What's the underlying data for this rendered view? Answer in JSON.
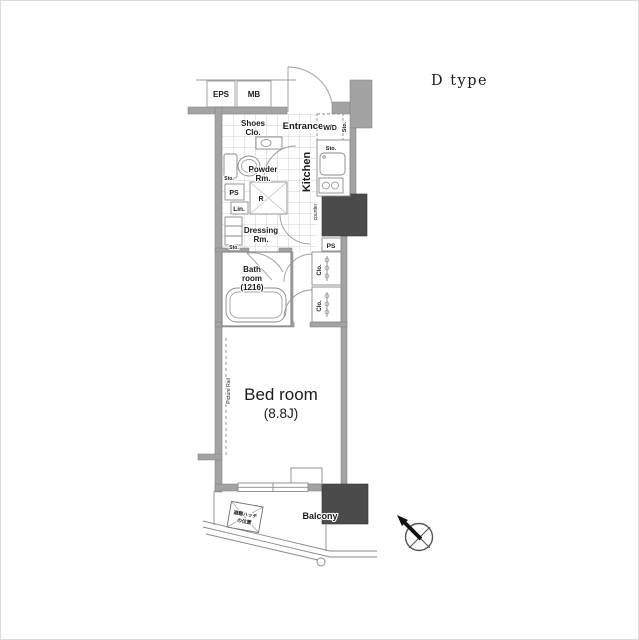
{
  "title": "D type",
  "labels": {
    "eps": "EPS",
    "mb": "MB",
    "entrance": "Entrance",
    "wd": "W/D",
    "sto": "Sto.",
    "shoes_line1": "Shoes",
    "shoes_line2": "Clo.",
    "kitchen": "Kitchen",
    "counter": "counter",
    "powder_line1": "Powder",
    "powder_line2": "Rm.",
    "ps": "PS",
    "lin": "Lin.",
    "refrigerator": "R",
    "dressing_line1": "Dressing",
    "dressing_line2": "Rm.",
    "bath_line1": "Bath",
    "bath_line2": "room",
    "bath_line3": "(1216)",
    "closet": "Clo.",
    "bedroom_name": "Bed room",
    "bedroom_size": "(8.8J)",
    "picture_rail": "Picture Rail",
    "balcony": "Balcony",
    "hatch_line1": "避難ハッチ",
    "hatch_line2": "の位置"
  },
  "colors": {
    "wall": "#a3a3a3",
    "pillar": "#4b4b4b",
    "outline": "#8a8a8a",
    "grid": "#c3c3c3",
    "text": "#1b1b1b"
  }
}
